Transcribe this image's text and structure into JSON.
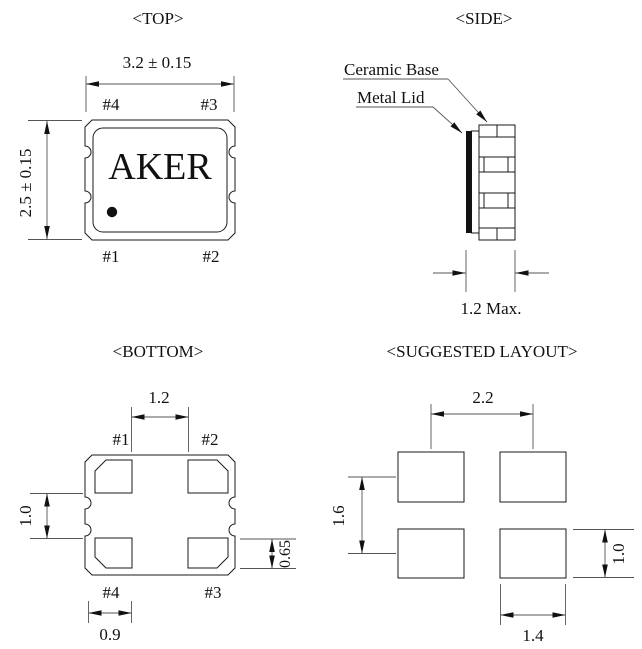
{
  "colors": {
    "line": "#1a1a1a",
    "background": "#ffffff",
    "hatch": "#6b6b6b"
  },
  "top_view": {
    "title": "<TOP>",
    "brand": "AKER",
    "width_dim": "3.2 ± 0.15",
    "height_dim": "2.5 ± 0.15",
    "pin_top_left": "#4",
    "pin_top_right": "#3",
    "pin_bottom_left": "#1",
    "pin_bottom_right": "#2"
  },
  "side_view": {
    "title": "<SIDE>",
    "ceramic_label": "Ceramic Base",
    "lid_label": "Metal Lid",
    "thickness_dim": "1.2 Max."
  },
  "bottom_view": {
    "title": "<BOTTOM>",
    "pad_span_dim": "1.2",
    "pad_gap_dim": "1.0",
    "pad_height_dim": "0.65",
    "pad_width_dim": "0.9",
    "pin_top_left": "#1",
    "pin_top_right": "#2",
    "pin_bottom_left": "#4",
    "pin_bottom_right": "#3"
  },
  "layout_view": {
    "title": "<SUGGESTED LAYOUT>",
    "pitch_x_dim": "2.2",
    "pitch_y_dim": "1.6",
    "pad_height_dim": "1.0",
    "pad_width_dim": "1.4"
  }
}
